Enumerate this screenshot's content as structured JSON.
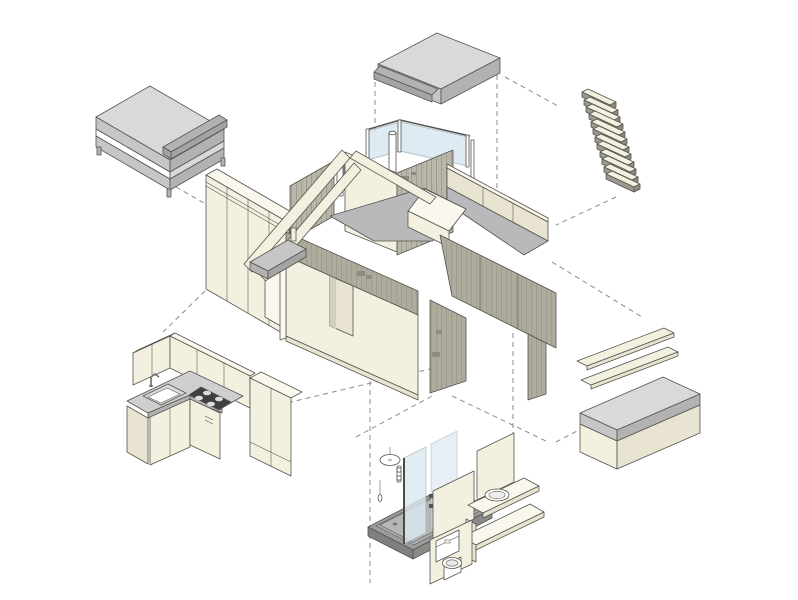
{
  "diagram": {
    "type": "exploded-axonometric-diagram",
    "subject": "tiny-house-components",
    "background": "#ffffff",
    "palette": {
      "outline": "#55544e",
      "dash": "#8c8c8c",
      "cream": "#f3f0df",
      "cream_light": "#faf8ee",
      "cream_dark": "#e8e4d1",
      "wood": "#bcb9ac",
      "wood_dark": "#b0ad9f",
      "wood_stripe": "#a09d90",
      "gray_light": "#d9d9d9",
      "gray_mid": "#c6c6c6",
      "gray_dark": "#b2b2b2",
      "gray_darker": "#a4a4a4",
      "floor_gray": "#b9b9bc",
      "counter": "#cfcfcf",
      "glass": "#dce9f1",
      "glass_edge": "#9db1bf",
      "tray": "#9c9c9c",
      "tray_inner": "#ababab",
      "tray_floor": "#b6b6b6",
      "white": "#ffffff",
      "cooktop": "#3f3f3f",
      "stamp": "#8d8b83",
      "door_shadow": "#d4d0bd",
      "rung_side": "#9c9a8e",
      "rung_cap": "#8e8c80"
    },
    "components": [
      {
        "id": "double-bed",
        "label": "double bed"
      },
      {
        "id": "wardrobe",
        "label": "wardrobe"
      },
      {
        "id": "house-shell",
        "label": "house shell"
      },
      {
        "id": "loft-mattress",
        "label": "loft mattress"
      },
      {
        "id": "loft-ladder",
        "label": "loft ladder"
      },
      {
        "id": "kitchen-block",
        "label": "kitchen block"
      },
      {
        "id": "bathroom-module",
        "label": "bathroom module"
      },
      {
        "id": "wall-shelves",
        "label": "wall shelves"
      },
      {
        "id": "storage-bench",
        "label": "storage bench"
      },
      {
        "id": "connectors",
        "label": "exploded-view connector lines"
      }
    ]
  }
}
